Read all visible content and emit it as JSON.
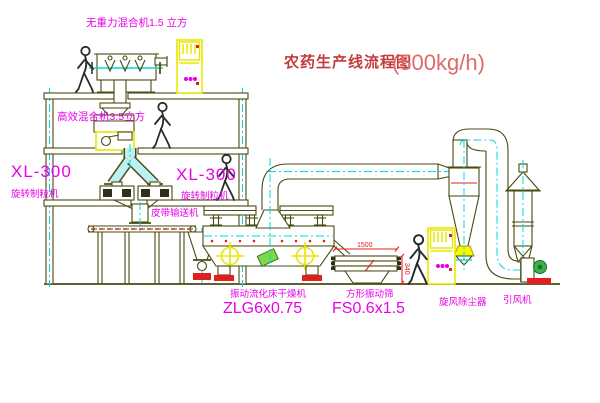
{
  "diagram": {
    "title": "农药生产线流程图",
    "title_capacity": "(500kg/h)",
    "equipment": {
      "mixer_top_label": "无重力混合机1.5 立方",
      "mixer_mid_label": "高效混合机3.5立方",
      "granulator_left_model": "XL-300",
      "granulator_left_name": "旋转制粒机",
      "granulator_right_model": "XL-300",
      "granulator_right_name": "旋转制粒机",
      "belt_conveyor_label": "皮带输送机",
      "dryer_name": "振动流化床干燥机",
      "dryer_model": "ZLG6x0.75",
      "sieve_name": "方形振动筛",
      "sieve_model": "FS0.6x1.5",
      "cyclone_label": "旋风除尘器",
      "fan_label": "引风机"
    },
    "dimensions": {
      "sieve_width": "1500",
      "sieve_height": "340"
    },
    "colors": {
      "line": "#4a4a12",
      "centerline": "#00d8d8",
      "label_magenta": "#e800e8",
      "title_red": "#c43b3b",
      "highlight_yellow": "#f6f600",
      "accent_red": "#e02020",
      "accent_green": "#39b24a",
      "background": "#ffffff"
    }
  }
}
